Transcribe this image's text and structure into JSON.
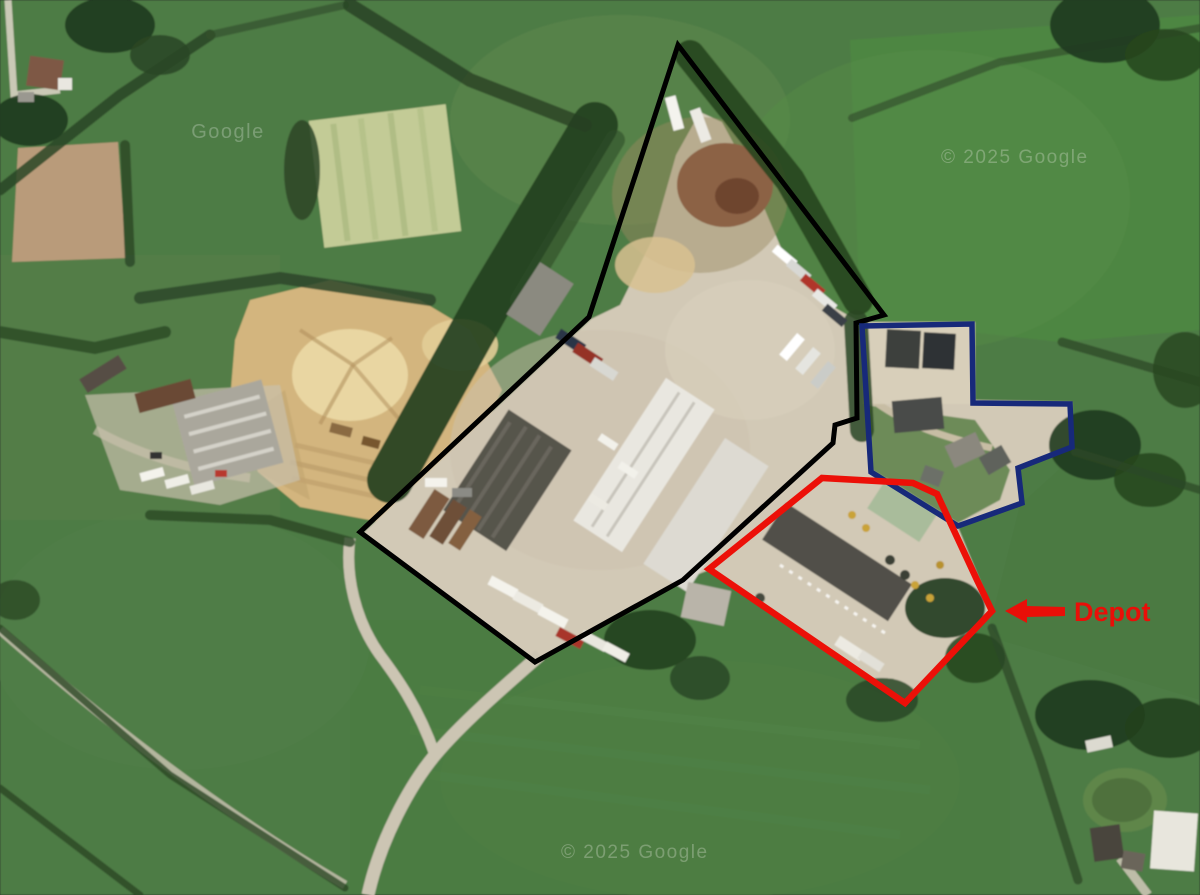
{
  "map": {
    "type": "satellite-imagery",
    "watermarks": {
      "top_left": "Google",
      "top_right": "© 2025 Google",
      "bottom_center": "© 2025 Google"
    }
  },
  "annotations": {
    "site_outline_black": {
      "color": "#000000",
      "stroke_width": 5,
      "points": "678,45 884,315 856,323 857,418 835,425 833,443 683,580 535,662 360,532 589,317"
    },
    "parcel_outline_blue": {
      "color": "#17297a",
      "stroke_width": 5.5,
      "points": "862,326 972,324 973,403 1070,404 1072,447 1018,468 1022,503 958,526 871,472"
    },
    "depot_outline_red": {
      "color": "#ec1008",
      "stroke_width": 6.5,
      "points": "709,569 822,478 913,483 937,494 957,537 977,580 992,611 905,703"
    },
    "depot_callout": {
      "label": "Depot",
      "color": "#e90f08",
      "text_x": 1074,
      "text_y": 621,
      "arrow_points": "1005,611 1027,599 1027,606 1065,607 1065,616 1027,617 1027,623"
    }
  }
}
